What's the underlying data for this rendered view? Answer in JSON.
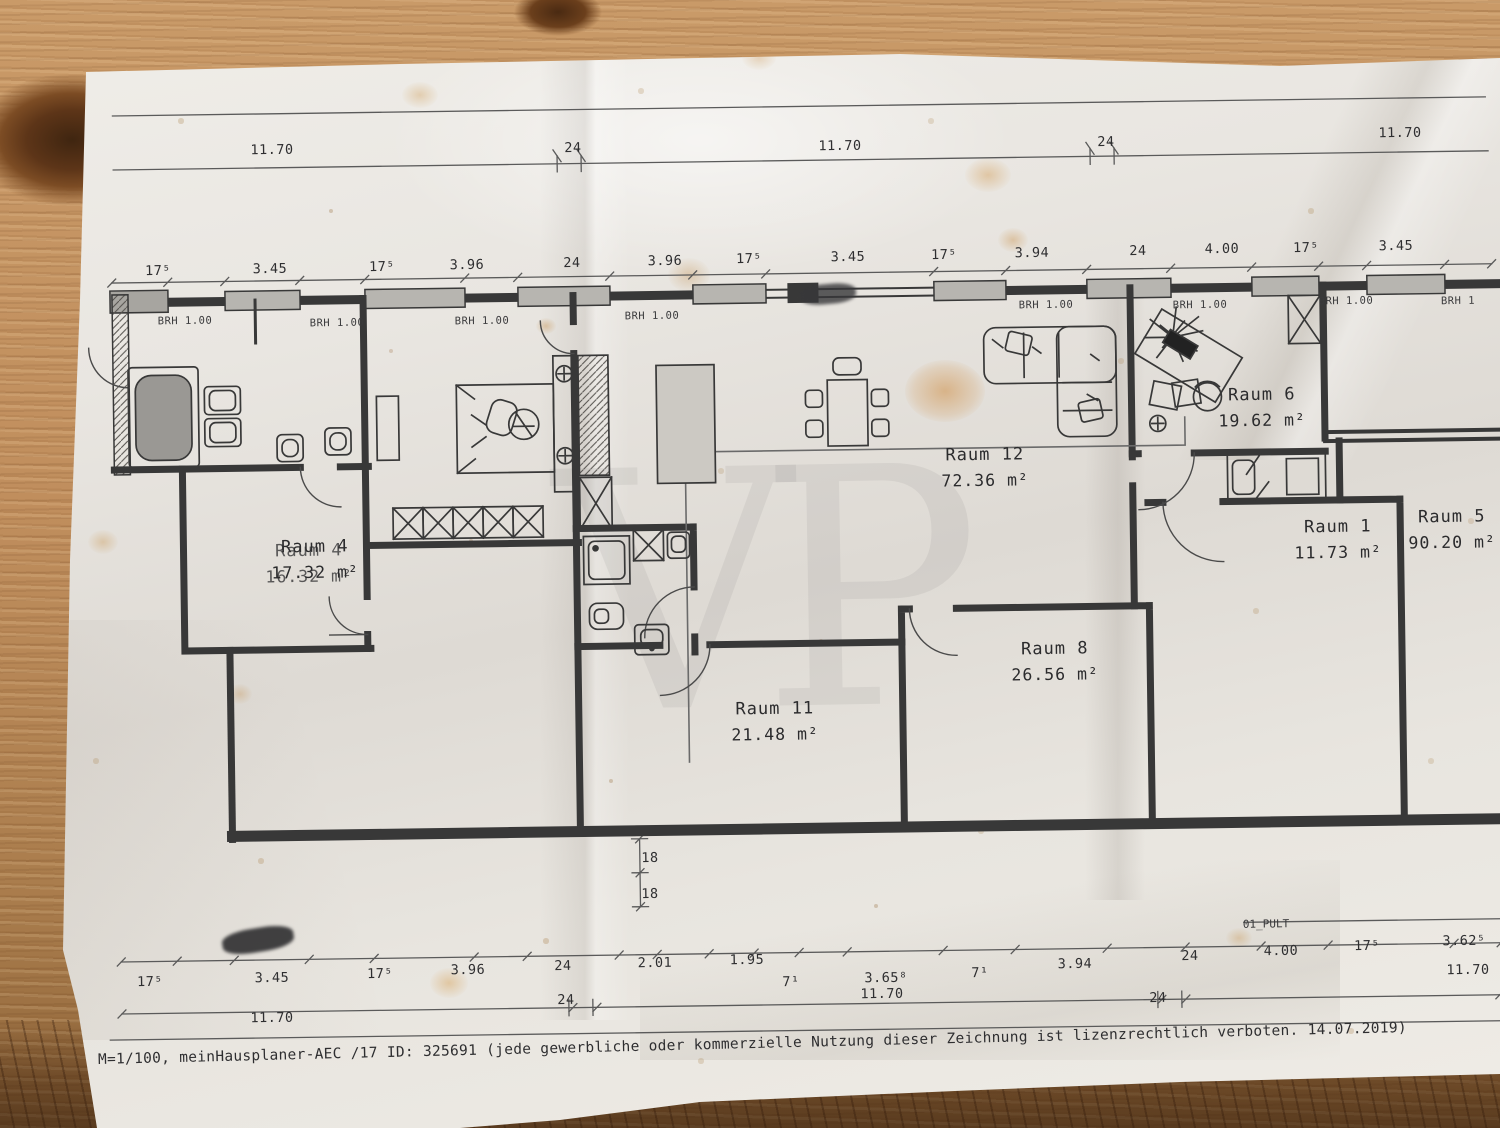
{
  "watermark": "VP",
  "scale_note": "M=1/100",
  "footer": "M=1/100, meinHausplaner-AEC /17 ID: 325691 (jede gewerbliche oder kommerzielle Nutzung dieser Zeichnung ist lizenzrechtlich verboten. 14.07.2019)",
  "rooms": [
    {
      "label": "Raum 4",
      "area": "17.32 m²"
    },
    {
      "label": "Raum 12",
      "area": "72.36 m²"
    },
    {
      "label": "Raum 6",
      "area": "19.62 m²"
    },
    {
      "label": "Raum 1",
      "area": "11.73 m²"
    },
    {
      "label": "Raum 5",
      "area": "90.20 m²"
    },
    {
      "label": "Raum 8",
      "area": "26.56 m²"
    },
    {
      "label": "Raum 11",
      "area": "21.48 m²"
    }
  ],
  "room4_ghost": {
    "label": "Raum 4",
    "area": "16.32 m²"
  },
  "brh_labels": [
    {
      "t": "BRH 1.00"
    },
    {
      "t": "BRH 1.00"
    },
    {
      "t": "BRH 1.00"
    },
    {
      "t": "BRH 1.00"
    },
    {
      "t": "BRH 1.00"
    },
    {
      "t": "BRH 1.00"
    },
    {
      "t": "BRH 1.00"
    },
    {
      "t": "BRH 1"
    }
  ],
  "dims": {
    "top_main": [
      {
        "t": "11.70"
      },
      {
        "t": "24"
      },
      {
        "t": "11.70"
      },
      {
        "t": "24"
      },
      {
        "t": "11.70"
      }
    ],
    "top_win": [
      {
        "t": "17⁵"
      },
      {
        "t": "3.45"
      },
      {
        "t": "17⁵"
      },
      {
        "t": "3.96"
      },
      {
        "t": "24"
      },
      {
        "t": "3.96"
      },
      {
        "t": "17⁵"
      },
      {
        "t": "3.45"
      },
      {
        "t": "17⁵"
      },
      {
        "t": "3.94"
      },
      {
        "t": "24"
      },
      {
        "t": "4.00"
      },
      {
        "t": "17⁵"
      },
      {
        "t": "3.45"
      }
    ],
    "bottom_main": [
      {
        "t": "17⁵"
      },
      {
        "t": "3.45"
      },
      {
        "t": "17⁵"
      },
      {
        "t": "3.96"
      },
      {
        "t": "24"
      },
      {
        "t": "2.01"
      },
      {
        "t": "1.95"
      },
      {
        "t": "7¹"
      },
      {
        "t": "3.65⁸"
      },
      {
        "t": "7¹"
      },
      {
        "t": "3.94"
      },
      {
        "t": "24"
      },
      {
        "t": "4.00"
      },
      {
        "t": "17⁵"
      },
      {
        "t": "3.62⁵"
      }
    ],
    "bottom_extra": [
      {
        "t": "24"
      },
      {
        "t": "24"
      }
    ],
    "bottom_1170": [
      {
        "t": "11.70"
      },
      {
        "t": "11.70"
      },
      {
        "t": "11.70"
      }
    ],
    "v18": [
      {
        "t": "18"
      },
      {
        "t": "18"
      }
    ],
    "pult": "01_PULT"
  },
  "colors": {
    "paper": "#e9e6e1",
    "ink": "#383838",
    "window_fill": "#b7b5b0",
    "wood": "#c29363"
  }
}
